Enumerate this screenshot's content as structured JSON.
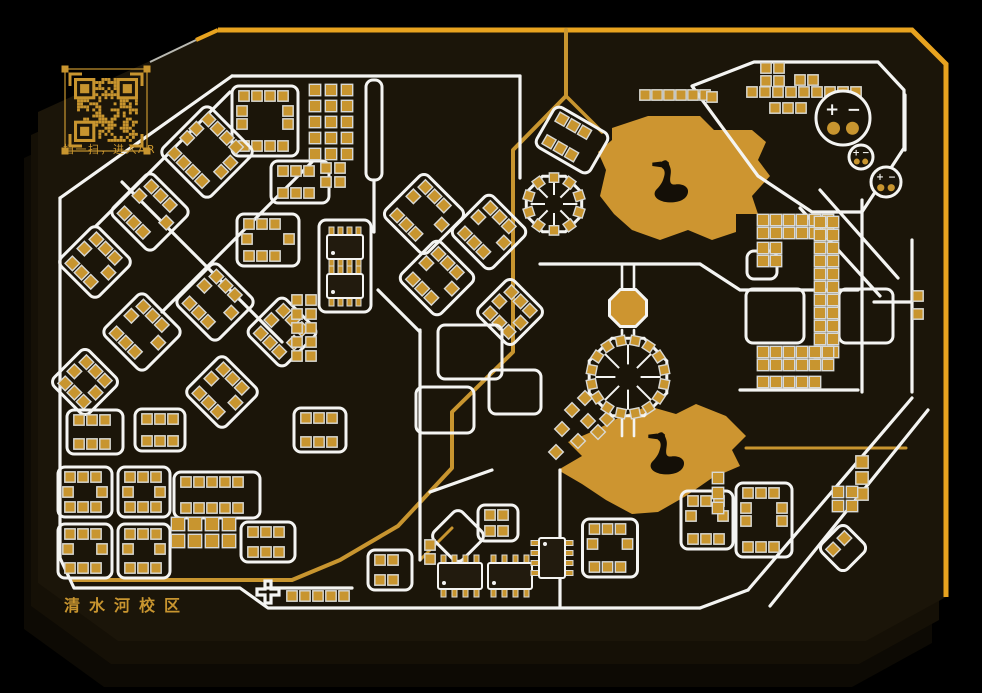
{
  "colors": {
    "outer": "#000000",
    "board": "#1b1509",
    "board_mid": "#151006",
    "board_side": "#0d0a04",
    "edge_gold": "#e8a31f",
    "gold": "#c8952f",
    "gold_bright": "#d8a93c",
    "lake": "#cd9530",
    "white": "#f4f4f2",
    "pad_rim": "#d9d9d4",
    "ic_body": "#221b0e",
    "dark": "#140f07"
  },
  "board": {
    "points": [
      [
        218,
        30
      ],
      [
        912,
        30
      ],
      [
        946,
        64
      ],
      [
        946,
        597
      ],
      [
        866,
        641
      ],
      [
        118,
        641
      ],
      [
        38,
        583
      ],
      [
        38,
        112
      ]
    ],
    "edge_path": "M218 30 L912 30 L946 64 L946 597",
    "edge_tick": "M218 30 L196 40",
    "chamfer_line": "M196 40 L150 62"
  },
  "qr": {
    "x": 74,
    "y": 78,
    "size": 64,
    "modules": 21,
    "caption": "扫一扫，进入AR"
  },
  "campus_label": {
    "text": "清水河校区"
  },
  "batteries": [
    {
      "cx": 843,
      "cy": 118,
      "r": 27,
      "plus": "+",
      "minus": "−"
    },
    {
      "cx": 861,
      "cy": 157,
      "r": 12,
      "plus": "+",
      "minus": "−"
    },
    {
      "cx": 886,
      "cy": 182,
      "r": 15,
      "plus": "+",
      "minus": "−"
    }
  ],
  "lakes": [
    {
      "name": "upper-lake",
      "points": [
        [
          612,
          128
        ],
        [
          648,
          116
        ],
        [
          700,
          116
        ],
        [
          714,
          130
        ],
        [
          752,
          130
        ],
        [
          766,
          142
        ],
        [
          758,
          160
        ],
        [
          770,
          176
        ],
        [
          752,
          196
        ],
        [
          758,
          214
        ],
        [
          736,
          214
        ],
        [
          736,
          232
        ],
        [
          712,
          240
        ],
        [
          688,
          230
        ],
        [
          660,
          240
        ],
        [
          632,
          230
        ],
        [
          614,
          214
        ],
        [
          600,
          196
        ],
        [
          606,
          170
        ],
        [
          598,
          152
        ],
        [
          612,
          140
        ]
      ],
      "swan": {
        "x": 650,
        "y": 158,
        "s": 1.15
      }
    },
    {
      "name": "lower-lake",
      "points": [
        [
          618,
          418
        ],
        [
          648,
          406
        ],
        [
          676,
          414
        ],
        [
          696,
          404
        ],
        [
          726,
          416
        ],
        [
          746,
          436
        ],
        [
          732,
          450
        ],
        [
          740,
          466
        ],
        [
          712,
          478
        ],
        [
          686,
          496
        ],
        [
          658,
          512
        ],
        [
          632,
          514
        ],
        [
          606,
          500
        ],
        [
          582,
          484
        ],
        [
          558,
          470
        ],
        [
          582,
          456
        ],
        [
          568,
          442
        ],
        [
          596,
          430
        ]
      ],
      "swan": {
        "x": 646,
        "y": 430,
        "s": 1.15
      }
    }
  ],
  "roads_gold": [
    {
      "d": "M566 30 V96 L513 150 V352 L452 412 V468 L398 526 L340 560 L292 580 L74 580",
      "w": 4
    },
    {
      "d": "M566 96 L602 132",
      "w": 3.5
    },
    {
      "d": "M746 448 H906",
      "w": 3
    },
    {
      "d": "M420 560 L452 528",
      "w": 3
    }
  ],
  "roads_white": [
    {
      "d": "M232 76 H520",
      "w": 3.2
    },
    {
      "d": "M232 76 L60 198",
      "w": 3.2
    },
    {
      "d": "M60 198 V558",
      "w": 3.2
    },
    {
      "d": "M60 558 L74 588 H240 L268 608 H700",
      "w": 3.2
    },
    {
      "d": "M700 608 L748 590",
      "w": 3.2
    },
    {
      "d": "M912 398 L748 590",
      "w": 3.2
    },
    {
      "d": "M928 410 L770 606",
      "w": 3.2
    },
    {
      "d": "M905 95 V150",
      "w": 3.2
    },
    {
      "d": "M912 240 V392",
      "w": 3.2
    },
    {
      "d": "M692 86 L754 62 L878 62 L904 90 L904 148 L862 212 L812 212 L758 176 Z",
      "w": 3.2
    },
    {
      "d": "M820 190 L898 278",
      "w": 3.2
    },
    {
      "d": "M800 208 L880 296",
      "w": 3.2
    },
    {
      "d": "M374 180 V232",
      "w": 3.2
    },
    {
      "d": "M420 330 V560",
      "w": 3.2
    },
    {
      "d": "M420 332 L378 290",
      "w": 3.2
    },
    {
      "d": "M540 264 H700",
      "w": 3.2
    },
    {
      "d": "M700 264 L740 290 H858",
      "w": 3.2
    },
    {
      "d": "M862 200 V392",
      "w": 3.2
    },
    {
      "d": "M740 390 H858",
      "w": 3.2
    },
    {
      "d": "M874 302 H912",
      "w": 3.2
    },
    {
      "d": "M520 76 V178",
      "w": 3.2
    },
    {
      "d": "M622 264 V288",
      "w": 2.6
    },
    {
      "d": "M634 264 V288",
      "w": 2.6
    },
    {
      "d": "M622 330 V336",
      "w": 2.6
    },
    {
      "d": "M634 330 V336",
      "w": 2.6
    },
    {
      "d": "M622 419 V436",
      "w": 2.6
    },
    {
      "d": "M634 419 V436",
      "w": 2.6
    },
    {
      "d": "M230 92 L96 226",
      "w": 3.2
    },
    {
      "d": "M312 162 L162 312",
      "w": 3.2
    },
    {
      "d": "M122 182 L282 342",
      "w": 3.2
    },
    {
      "d": "M266 588 H352",
      "w": 3.2
    },
    {
      "d": "M560 470 V606",
      "w": 3.2
    },
    {
      "d": "M430 492 L492 470",
      "w": 3.2
    }
  ],
  "rings": [
    [
      265,
      121,
      66,
      70,
      0,
      1
    ],
    [
      207,
      152,
      68,
      68,
      45,
      1
    ],
    [
      374,
      130,
      16,
      100,
      0,
      0
    ],
    [
      300,
      182,
      58,
      42,
      0,
      1
    ],
    [
      150,
      212,
      58,
      58,
      45,
      1
    ],
    [
      95,
      262,
      54,
      54,
      45,
      1
    ],
    [
      268,
      240,
      62,
      52,
      0,
      1
    ],
    [
      215,
      302,
      58,
      58,
      45,
      1
    ],
    [
      142,
      332,
      58,
      58,
      45,
      1
    ],
    [
      85,
      382,
      50,
      50,
      45,
      1
    ],
    [
      282,
      332,
      52,
      52,
      45,
      1
    ],
    [
      95,
      432,
      56,
      44,
      0,
      1
    ],
    [
      160,
      430,
      50,
      42,
      0,
      1
    ],
    [
      222,
      392,
      54,
      54,
      45,
      1
    ],
    [
      345,
      266,
      52,
      92,
      0,
      0
    ],
    [
      85,
      492,
      54,
      50,
      0,
      1
    ],
    [
      85,
      551,
      54,
      54,
      0,
      1
    ],
    [
      144,
      492,
      52,
      50,
      0,
      1
    ],
    [
      144,
      551,
      52,
      54,
      0,
      1
    ],
    [
      217,
      495,
      86,
      46,
      0,
      1
    ],
    [
      268,
      542,
      54,
      40,
      0,
      1
    ],
    [
      424,
      214,
      60,
      60,
      45,
      1
    ],
    [
      489,
      232,
      56,
      56,
      45,
      1
    ],
    [
      437,
      278,
      56,
      56,
      45,
      1
    ],
    [
      510,
      312,
      50,
      50,
      45,
      1
    ],
    [
      470,
      352,
      64,
      54,
      0,
      0
    ],
    [
      445,
      410,
      58,
      46,
      0,
      0
    ],
    [
      515,
      392,
      52,
      44,
      0,
      0
    ],
    [
      572,
      140,
      62,
      46,
      30,
      1
    ],
    [
      390,
      570,
      44,
      40,
      0,
      1
    ],
    [
      458,
      536,
      40,
      40,
      45,
      0
    ],
    [
      498,
      523,
      40,
      36,
      0,
      1
    ],
    [
      707,
      520,
      52,
      58,
      0,
      1
    ],
    [
      764,
      520,
      56,
      74,
      0,
      1
    ],
    [
      762,
      265,
      30,
      28,
      0,
      0
    ],
    [
      775,
      316,
      58,
      54,
      0,
      0
    ],
    [
      866,
      316,
      54,
      54,
      0,
      0
    ],
    [
      843,
      548,
      36,
      36,
      45,
      1
    ],
    [
      320,
      430,
      52,
      44,
      0,
      1
    ],
    [
      610,
      548,
      55,
      58,
      0,
      1
    ]
  ],
  "grids": [
    [
      315,
      90,
      3,
      5,
      16,
      10
    ],
    [
      326,
      168,
      2,
      2,
      14,
      9
    ],
    [
      297,
      300,
      2,
      5,
      14,
      9
    ],
    [
      178,
      524,
      4,
      2,
      17,
      12
    ],
    [
      645,
      95,
      6,
      1,
      12,
      9
    ],
    [
      712,
      97,
      1,
      1,
      12,
      9
    ],
    [
      766,
      68,
      2,
      2,
      13,
      9
    ],
    [
      800,
      80,
      2,
      1,
      13,
      9
    ],
    [
      752,
      92,
      9,
      1,
      13,
      9
    ],
    [
      775,
      108,
      3,
      1,
      13,
      9
    ],
    [
      763,
      220,
      6,
      2,
      13,
      10
    ],
    [
      763,
      248,
      2,
      2,
      13,
      10
    ],
    [
      820,
      222,
      2,
      11,
      13,
      10
    ],
    [
      763,
      352,
      6,
      2,
      13,
      10
    ],
    [
      763,
      382,
      5,
      1,
      13,
      10
    ],
    [
      718,
      478,
      1,
      3,
      15,
      10
    ],
    [
      862,
      462,
      1,
      3,
      16,
      11
    ],
    [
      838,
      492,
      2,
      2,
      14,
      10
    ],
    [
      292,
      596,
      5,
      1,
      13,
      9
    ],
    [
      430,
      545,
      1,
      2,
      14,
      9
    ],
    [
      918,
      296,
      1,
      2,
      18,
      9
    ]
  ],
  "pads": [
    [
      585,
      398
    ],
    [
      572,
      410
    ],
    [
      588,
      421
    ],
    [
      562,
      429
    ],
    [
      578,
      441
    ],
    [
      556,
      452
    ],
    [
      598,
      432
    ],
    [
      607,
      419
    ]
  ],
  "soics": [
    [
      345,
      247,
      36,
      24,
      0
    ],
    [
      345,
      286,
      36,
      24,
      0
    ],
    [
      460,
      576,
      44,
      26,
      0
    ],
    [
      510,
      576,
      44,
      26,
      0
    ],
    [
      552,
      558,
      26,
      40,
      90
    ]
  ],
  "octrings": [
    [
      628,
      377,
      42
    ],
    [
      554,
      204,
      30
    ]
  ],
  "octpads": [
    [
      628,
      308,
      20
    ]
  ],
  "crosses": [
    [
      268,
      592,
      11
    ]
  ]
}
